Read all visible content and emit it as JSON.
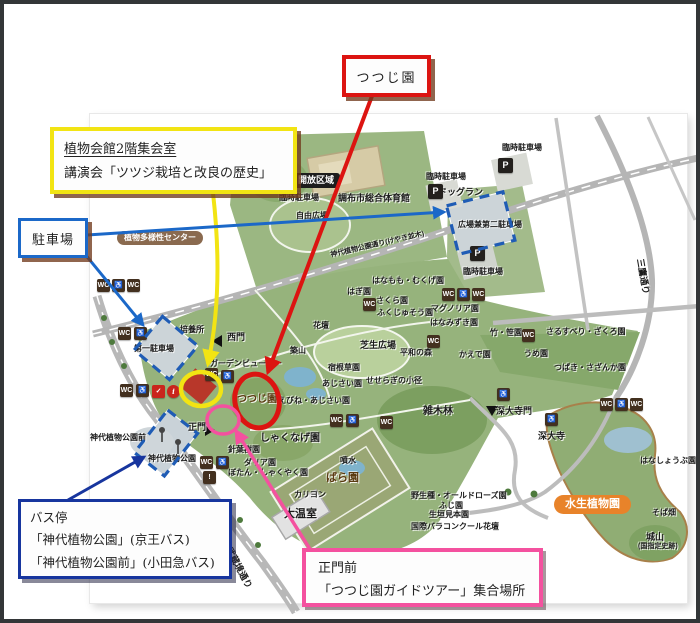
{
  "colors": {
    "callout_red": "#dc1411",
    "callout_yellow": "#f2e413",
    "callout_blue": "#1b68c8",
    "callout_navy": "#17359e",
    "callout_pink": "#f4519f",
    "dashed_parking_blue": "#1f5cb5",
    "park_green": "#96b37c",
    "road_gray": "#b8b8b8",
    "icon_brown": "#43301f",
    "pill_brown": "#8a6a4f",
    "pill_orange": "#e8832a",
    "frame": "#333638"
  },
  "callouts": {
    "tsutsuji": {
      "label": "つつじ園"
    },
    "lecture": {
      "line1": "植物会館2階集会室",
      "line2": "講演会「ツツジ栽培と改良の歴史」"
    },
    "parking": {
      "label": "駐車場"
    },
    "bus": {
      "title": "バス停",
      "line1": "「神代植物公園」(京王バス)",
      "line2": "「神代植物公園前」(小田急バス)"
    },
    "gate": {
      "line1": "正門前",
      "line2": "「つつじ園ガイドツアー」集合場所"
    }
  },
  "map": {
    "pills": {
      "open_area": "開放区域",
      "diversity_center": "植物多様性センター",
      "aquatic_garden": "水生植物園"
    },
    "labels": [
      {
        "t": "臨時駐車場",
        "x": 502,
        "y": 144
      },
      {
        "t": "臨時駐車場",
        "x": 426,
        "y": 173
      },
      {
        "t": "臨時駐車場",
        "x": 279,
        "y": 194
      },
      {
        "t": "ドッグラン",
        "x": 438,
        "y": 188,
        "f": 9
      },
      {
        "t": "広場兼第二駐車場",
        "x": 458,
        "y": 221
      },
      {
        "t": "臨時駐車場",
        "x": 463,
        "y": 268
      },
      {
        "t": "調布市総合体育館",
        "x": 338,
        "y": 194,
        "f": 9
      },
      {
        "t": "自由広場",
        "x": 296,
        "y": 212
      },
      {
        "t": "はなもも・むくげ園",
        "x": 372,
        "y": 277
      },
      {
        "t": "はぎ園",
        "x": 347,
        "y": 288
      },
      {
        "t": "さくら園",
        "x": 376,
        "y": 297
      },
      {
        "t": "ふくじゅそう園",
        "x": 377,
        "y": 309
      },
      {
        "t": "マグノリア園",
        "x": 431,
        "y": 305
      },
      {
        "t": "はなみずき園",
        "x": 430,
        "y": 319
      },
      {
        "t": "花壇",
        "x": 313,
        "y": 322
      },
      {
        "t": "培養所",
        "x": 180,
        "y": 326
      },
      {
        "t": "西門",
        "x": 227,
        "y": 333,
        "f": 9
      },
      {
        "t": "築山",
        "x": 290,
        "y": 347
      },
      {
        "t": "第一駐車場",
        "x": 134,
        "y": 345
      },
      {
        "t": "芝生広場",
        "x": 360,
        "y": 341,
        "f": 9
      },
      {
        "t": "平和の森",
        "x": 400,
        "y": 349
      },
      {
        "t": "かえで園",
        "x": 459,
        "y": 351
      },
      {
        "t": "竹・笹園",
        "x": 490,
        "y": 329
      },
      {
        "t": "さるすべり・ざくろ園",
        "x": 546,
        "y": 328
      },
      {
        "t": "うめ園",
        "x": 524,
        "y": 350
      },
      {
        "t": "つばき・さざんか園",
        "x": 554,
        "y": 364
      },
      {
        "t": "宿根草園",
        "x": 328,
        "y": 364
      },
      {
        "t": "あじさい園",
        "x": 322,
        "y": 380
      },
      {
        "t": "せせらぎの小径",
        "x": 366,
        "y": 377
      },
      {
        "t": "ガーデンビューロー",
        "x": 210,
        "y": 360
      },
      {
        "t": "つつじ園",
        "x": 237,
        "y": 395,
        "f": 10,
        "c": "#5a3a10"
      },
      {
        "t": "えびね・あじさい園",
        "x": 278,
        "y": 397
      },
      {
        "t": "しゃくなげ園",
        "x": 260,
        "y": 434,
        "f": 10
      },
      {
        "t": "雑木林",
        "x": 423,
        "y": 407,
        "f": 10
      },
      {
        "t": "深大寺門",
        "x": 496,
        "y": 407,
        "f": 9
      },
      {
        "t": "深大寺",
        "x": 538,
        "y": 432,
        "f": 9
      },
      {
        "t": "正門",
        "x": 188,
        "y": 423,
        "f": 9
      },
      {
        "t": "神代植物公園前",
        "x": 90,
        "y": 434
      },
      {
        "t": "神代植物公園",
        "x": 148,
        "y": 455
      },
      {
        "t": "針葉樹園",
        "x": 228,
        "y": 446
      },
      {
        "t": "ダリア園",
        "x": 244,
        "y": 459
      },
      {
        "t": "ぼたん・しゃくやく園",
        "x": 228,
        "y": 469
      },
      {
        "t": "ばら園",
        "x": 326,
        "y": 473,
        "f": 11,
        "c": "#5a3a10"
      },
      {
        "t": "噴水",
        "x": 340,
        "y": 457
      },
      {
        "t": "カリヨン",
        "x": 294,
        "y": 491
      },
      {
        "t": "大温室",
        "x": 284,
        "y": 509,
        "f": 11
      },
      {
        "t": "野生種・オールドローズ園",
        "x": 411,
        "y": 492
      },
      {
        "t": "ふじ園",
        "x": 439,
        "y": 502
      },
      {
        "t": "生垣見本園",
        "x": 429,
        "y": 511
      },
      {
        "t": "国際バラコンクール花壇",
        "x": 411,
        "y": 523
      },
      {
        "t": "はなしょうぶ園",
        "x": 640,
        "y": 457
      },
      {
        "t": "そば畑",
        "x": 652,
        "y": 509
      },
      {
        "t": "城山",
        "x": 646,
        "y": 533,
        "f": 9
      },
      {
        "t": "(国指定史跡)",
        "x": 638,
        "y": 543,
        "f": 7
      },
      {
        "t": "三鷹通り",
        "x": 644,
        "y": 258,
        "rot": 80,
        "f": 9
      },
      {
        "t": "武蔵境通り",
        "x": 232,
        "y": 546,
        "rot": 62,
        "f": 9
      },
      {
        "t": "神代植物公園通り(けやき並木)",
        "x": 330,
        "y": 252,
        "rot": -13,
        "f": 7
      }
    ],
    "icons": [
      {
        "g": "P",
        "x": 498,
        "y": 158,
        "v": "p",
        "n": "parking-icon"
      },
      {
        "g": "P",
        "x": 428,
        "y": 184,
        "v": "p",
        "n": "parking-icon"
      },
      {
        "g": "P",
        "x": 470,
        "y": 246,
        "v": "p",
        "n": "parking-icon"
      },
      {
        "g": "WC",
        "x": 97,
        "y": 279,
        "n": "toilet-icon"
      },
      {
        "g": "♿",
        "x": 112,
        "y": 279,
        "n": "accessibility-icon"
      },
      {
        "g": "WC",
        "x": 127,
        "y": 279,
        "n": "toilet-icon"
      },
      {
        "g": "WC",
        "x": 118,
        "y": 327,
        "n": "toilet-icon"
      },
      {
        "g": "♿",
        "x": 134,
        "y": 327,
        "n": "accessibility-icon"
      },
      {
        "g": "WC",
        "x": 120,
        "y": 384,
        "n": "toilet-icon"
      },
      {
        "g": "♿",
        "x": 136,
        "y": 384,
        "n": "accessibility-icon"
      },
      {
        "g": "✓",
        "x": 152,
        "y": 385,
        "v": "red",
        "n": "checkpoint-icon"
      },
      {
        "g": "i",
        "x": 167,
        "y": 385,
        "v": "redc",
        "n": "information-icon"
      },
      {
        "g": "WC",
        "x": 205,
        "y": 368,
        "n": "toilet-icon"
      },
      {
        "g": "♿",
        "x": 221,
        "y": 370,
        "n": "accessibility-icon"
      },
      {
        "g": "WC",
        "x": 363,
        "y": 298,
        "n": "toilet-icon"
      },
      {
        "g": "WC",
        "x": 427,
        "y": 335,
        "n": "toilet-icon"
      },
      {
        "g": "WC",
        "x": 442,
        "y": 288,
        "n": "toilet-icon"
      },
      {
        "g": "♿",
        "x": 457,
        "y": 288,
        "n": "accessibility-icon"
      },
      {
        "g": "WC",
        "x": 472,
        "y": 288,
        "n": "toilet-icon"
      },
      {
        "g": "WC",
        "x": 330,
        "y": 414,
        "n": "toilet-icon"
      },
      {
        "g": "♿",
        "x": 346,
        "y": 414,
        "n": "accessibility-icon"
      },
      {
        "g": "WC",
        "x": 380,
        "y": 416,
        "n": "toilet-icon"
      },
      {
        "g": "WC",
        "x": 522,
        "y": 329,
        "n": "toilet-icon"
      },
      {
        "g": "♿",
        "x": 497,
        "y": 388,
        "n": "accessibility-icon"
      },
      {
        "g": "♿",
        "x": 545,
        "y": 413,
        "n": "accessibility-icon"
      },
      {
        "g": "WC",
        "x": 600,
        "y": 398,
        "n": "toilet-icon"
      },
      {
        "g": "♿",
        "x": 615,
        "y": 398,
        "n": "accessibility-icon"
      },
      {
        "g": "WC",
        "x": 630,
        "y": 398,
        "n": "toilet-icon"
      },
      {
        "g": "WC",
        "x": 200,
        "y": 456,
        "n": "toilet-icon"
      },
      {
        "g": "♿",
        "x": 216,
        "y": 456,
        "n": "accessibility-icon"
      },
      {
        "g": "!",
        "x": 203,
        "y": 471,
        "n": "notice-icon"
      }
    ]
  }
}
